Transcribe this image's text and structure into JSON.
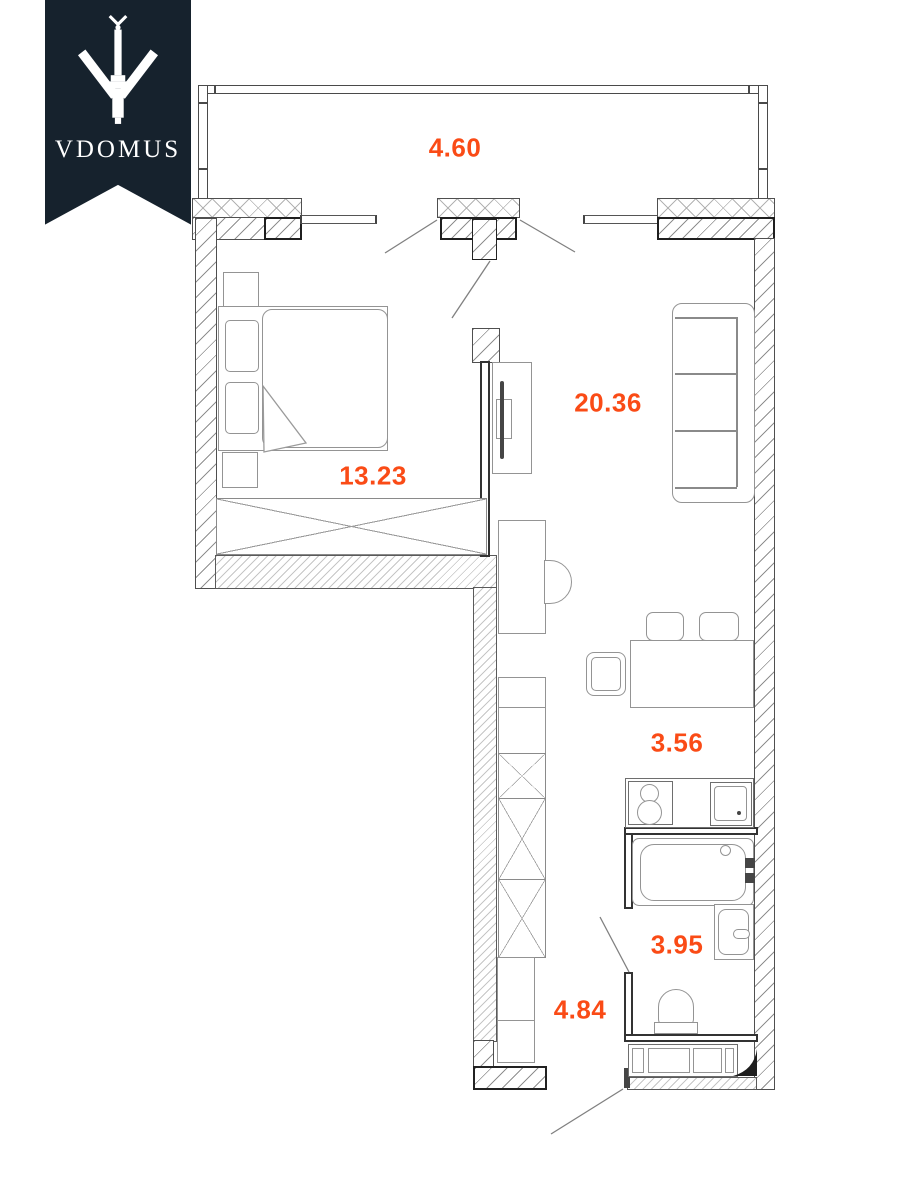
{
  "logo": {
    "brand": "VDOMUS",
    "icon": "monument-icon",
    "background": "#16222d",
    "text_color": "#ffffff"
  },
  "plan": {
    "accent_color": "#fa4b16",
    "line_color": "#4a4a4a",
    "rooms": [
      {
        "id": "balcony",
        "area": "4.60"
      },
      {
        "id": "living-room",
        "area": "20.36"
      },
      {
        "id": "bedroom",
        "area": "13.23"
      },
      {
        "id": "kitchen",
        "area": "3.56"
      },
      {
        "id": "bathroom",
        "area": "3.95"
      },
      {
        "id": "hallway",
        "area": "4.84"
      }
    ]
  }
}
